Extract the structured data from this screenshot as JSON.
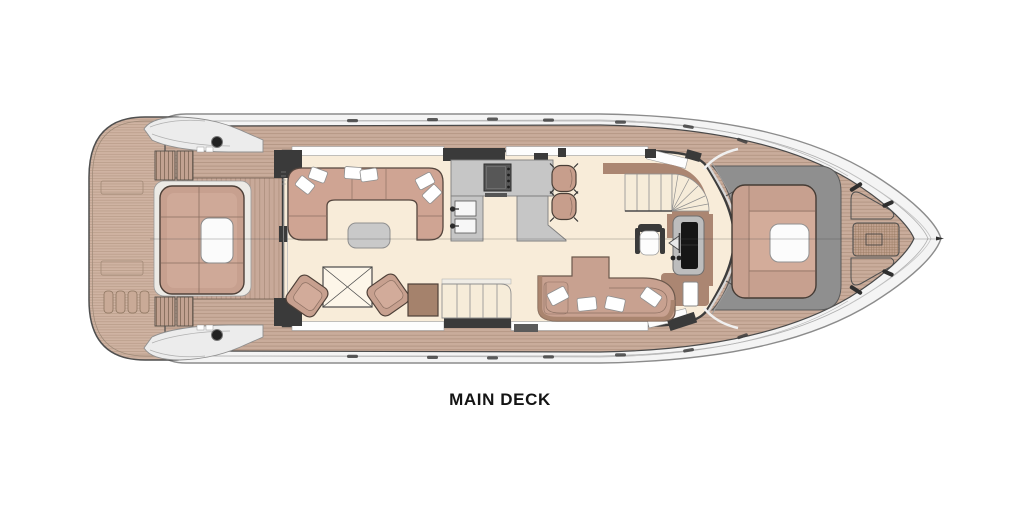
{
  "title": {
    "label": "MAIN DECK"
  },
  "plan": {
    "type": "yacht-deck-floor-plan",
    "deck_name": "Main Deck",
    "orientation": "bow-right, stern-left, top-down view",
    "colors": {
      "background": "#ffffff",
      "hull_white": "#f4f4f4",
      "deck_wood": "#c9ac9b",
      "plank_line": "#ad8f7c",
      "interior_floor": "#f8ecd9",
      "upholstery_rose": "#c7a08f",
      "upholstery_dark_brown": "#ab8672",
      "counter_gray": "#c6c6c6",
      "walkway_gray": "#8f8f8f",
      "wall_dark": "#3a3a3a",
      "outline_dark": "#4a4a4a"
    },
    "areas": [
      {
        "name": "swim-platform"
      },
      {
        "name": "aft-cockpit-seating"
      },
      {
        "name": "side-decks"
      },
      {
        "name": "salon-lounge"
      },
      {
        "name": "salon-card-table"
      },
      {
        "name": "galley"
      },
      {
        "name": "breakfast-bar-stools"
      },
      {
        "name": "stairs-to-lower-deck"
      },
      {
        "name": "stairs-to-flybridge"
      },
      {
        "name": "helm-station"
      },
      {
        "name": "dinette"
      },
      {
        "name": "side-door"
      },
      {
        "name": "bow-lounge"
      },
      {
        "name": "foredeck"
      },
      {
        "name": "anchor-windlass"
      }
    ]
  }
}
